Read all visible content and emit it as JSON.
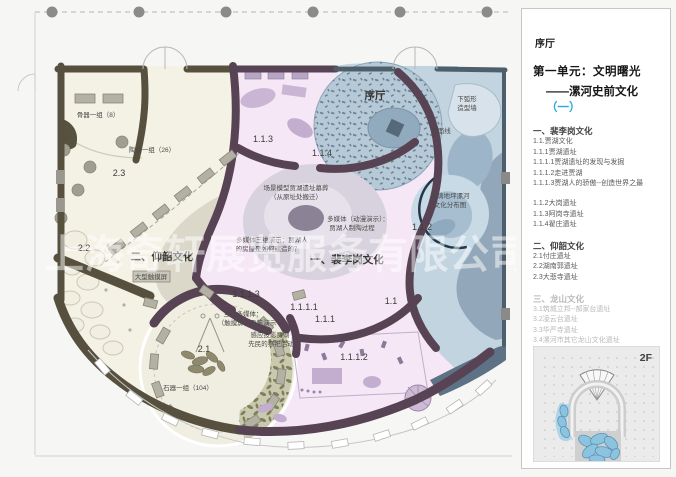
{
  "watermark": "上海奇轩展览服务有限公司",
  "plan": {
    "labels": {
      "bone_group": "骨器一组（8）",
      "pottery_group": "陶器一组（26）",
      "num_2_3": "2.3",
      "num_2_2": "2.2",
      "num_2_1": "2.1",
      "yangshao_title": "二、仰韶文化",
      "touchscreen": "大型触摸屏",
      "stone_group": "石器一组（104）",
      "peiligang_title": "一、裴李岗文化",
      "lobby": "序厅",
      "num_1_1": "1.1",
      "num_1_1_1": "1.1.1",
      "num_1_1_2": "1.1.2",
      "num_1_1_3": "1.1.3",
      "num_1_1_4": "1.1.4",
      "num_1_1_1_1": "1.1.1.1",
      "num_1_1_1_2": "1.1.1.2",
      "num_1_1_1_3": "1.1.1.3",
      "scene_model_line1": "场景模型贾湖遗址墓葬",
      "scene_model_line2": "（从原址处搬迁）",
      "mm_3d_line1": "多媒体三维演示：贾湖人",
      "mm_3d_line2": "的房屋是如何建造的？",
      "mm_anim_line1": "多媒体（动漫演示）：",
      "mm_anim_line2": "贾湖人制陶过程",
      "interactive_line1": "互动多媒体：",
      "interactive_line2": "（触摸屏）骨笛演示",
      "sensor_line1": "感应投影贾湖",
      "sensor_line2": "先民的祭祀活动",
      "arc_wall_line1": "下弧形",
      "arc_wall_line2": "造型墙",
      "ground_line": "地面线",
      "glass_line1": "玻璃地坪漯河",
      "glass_line2": "文化分布图"
    }
  },
  "panel": {
    "lobby": "序厅",
    "unit_title": "第一单元：文明曙光",
    "subtitle_dash": "——漯河史前文化",
    "subtitle_num": "（一）",
    "accent_color": "#29a8e1",
    "floor_label": "2F",
    "items": [
      {
        "text": "一、裴李岗文化"
      },
      {
        "text": "1.1.贾湖文化"
      },
      {
        "text": "1.1.1贾湖遗址"
      },
      {
        "text": "1.1.1.1贾湖遗址的发现与发掘"
      },
      {
        "text": "1.1.1.2走进贾湖"
      },
      {
        "text": "1.1.1.3贾湖人的骄傲--创造世界之最"
      },
      {
        "text": "1.1.2大岗遗址"
      },
      {
        "text": "1.1.3阿岗寺遗址"
      },
      {
        "text": "1.1.4翟庄遗址"
      },
      {
        "text": "二、仰韶文化"
      },
      {
        "text": "2.1付庄遗址"
      },
      {
        "text": "2.2湖南郭遗址"
      },
      {
        "text": "2.3大悲寺遗址"
      },
      {
        "text": "三、龙山文化"
      },
      {
        "text": "3.1筑城立邦--郝家台遗址"
      },
      {
        "text": "3.2凌云台遗址"
      },
      {
        "text": "3.3华严寺遗址"
      },
      {
        "text": "3.4漯河市其它龙山文化遗址"
      }
    ]
  }
}
